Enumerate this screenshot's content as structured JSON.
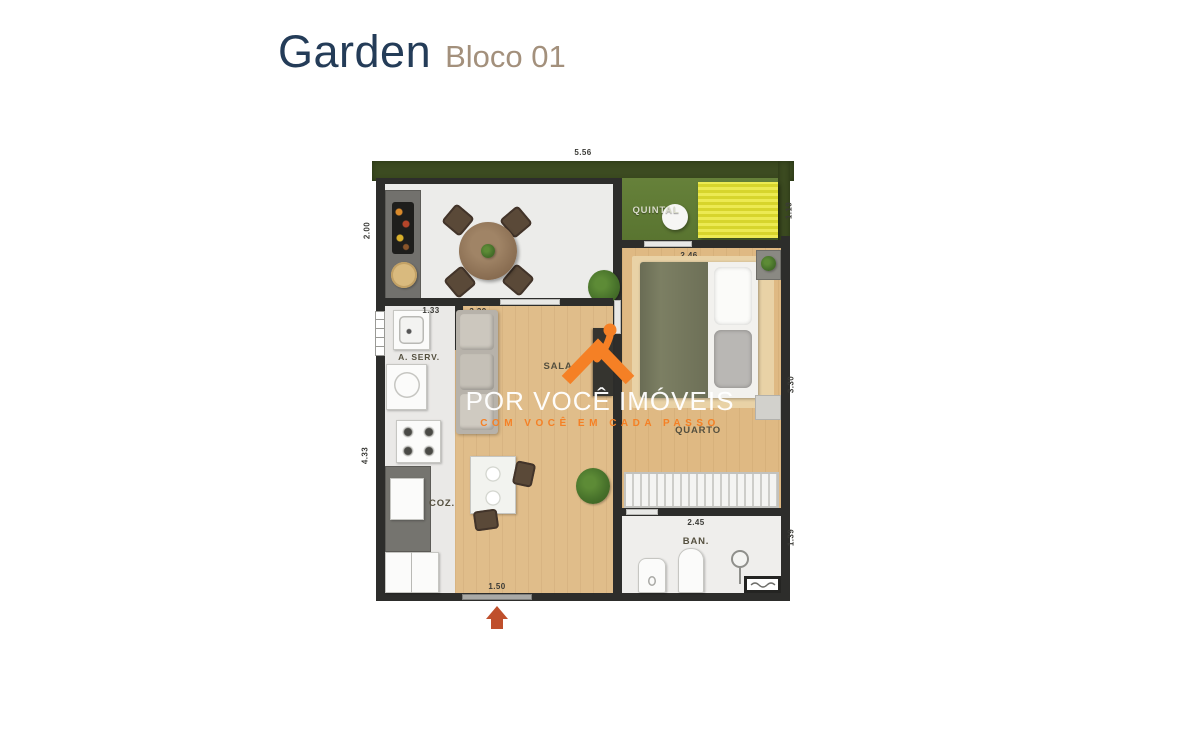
{
  "header": {
    "title": "Garden",
    "subtitle": "Bloco 01",
    "title_color": "#243c58",
    "subtitle_color": "#a3907c"
  },
  "floorplan": {
    "rooms": {
      "quintal": "QUINTAL",
      "service": "A. SERV.",
      "living": "SALA",
      "bedroom": "QUARTO",
      "kitchen": "COZ.",
      "bathroom": "BAN."
    },
    "dimensions": {
      "top_width": "5.56",
      "left_upper": "2.00",
      "left_lower": "4.33",
      "quintal_right": "1.19",
      "bedroom_width": "2.46",
      "living_width": "3.30",
      "bedroom_right": "3.30",
      "bathroom_width": "2.45",
      "bathroom_right": "1.39",
      "service_width": "1.33",
      "entrance_width": "1.50"
    },
    "colors": {
      "wall": "#2d2d2b",
      "lawn": "#5e7a33",
      "hedge": "#3c4b21",
      "deck_yellow": "#dfdd35",
      "wood_floor": "#e0bd8a",
      "entrance_arrow": "#bf4f2c"
    }
  },
  "watermark": {
    "brand": "POR VOCÊ IMÓVEIS",
    "tagline": "COM VOCÊ EM CADA PASSO",
    "brand_color": "#ffffff",
    "accent_color": "#f58025"
  },
  "icons": {
    "entrance_arrow": "▲",
    "logo": "house-roof-with-person"
  }
}
